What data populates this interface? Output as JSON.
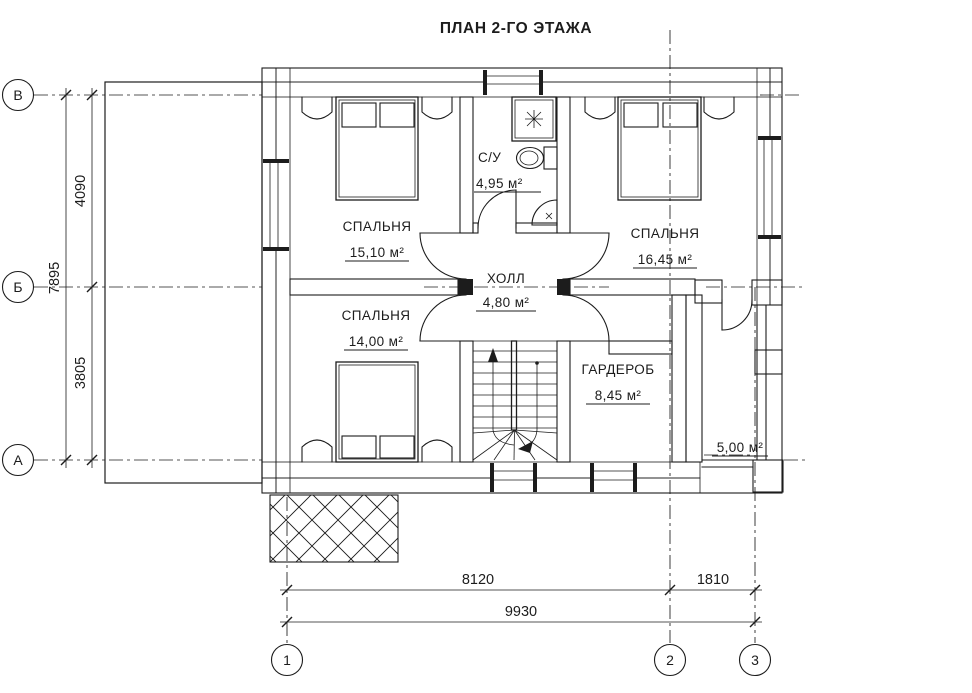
{
  "title": "ПЛАН 2-ГО ЭТАЖА",
  "rooms": {
    "bedroom1": {
      "name": "СПАЛЬНЯ",
      "area": "15,10 м²"
    },
    "bathroom": {
      "name": "С/У",
      "area": "4,95 м²"
    },
    "bedroom2": {
      "name": "СПАЛЬНЯ",
      "area": "16,45 м²"
    },
    "hall": {
      "name": "ХОЛЛ",
      "area": "4,80 м²"
    },
    "bedroom3": {
      "name": "СПАЛЬНЯ",
      "area": "14,00 м²"
    },
    "wardrobe": {
      "name": "ГАРДЕРОБ",
      "area": "8,45 м²"
    },
    "balcony": {
      "area": "5,00 м²"
    }
  },
  "grid_axes": {
    "rows": [
      "В",
      "Б",
      "А"
    ],
    "columns": [
      "1",
      "2",
      "3"
    ]
  },
  "dimensions": {
    "left_segment_top": "4090",
    "left_segment_bottom": "3805",
    "left_total": "7895",
    "bottom_segment_left": "8120",
    "bottom_segment_right": "1810",
    "bottom_total": "9930"
  },
  "colors": {
    "ink": "#1c1c1c",
    "paper": "#ffffff"
  }
}
